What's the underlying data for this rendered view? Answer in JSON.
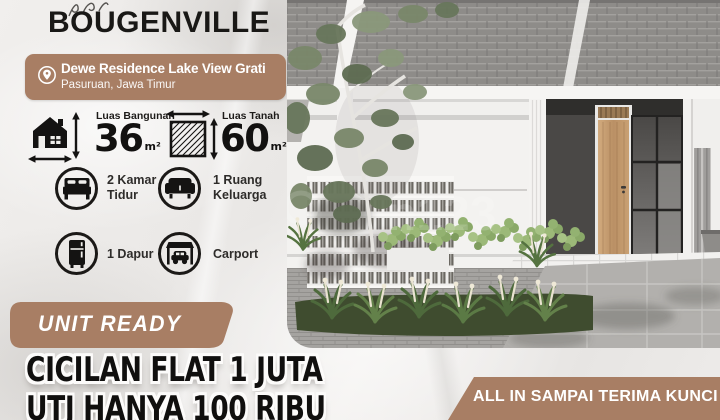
{
  "title": "BOUGENVILLE",
  "location": {
    "name": "Dewe Residence Lake View Grati",
    "region": "Pasuruan, Jawa Timur"
  },
  "specs": {
    "building": {
      "label": "Luas Bangunan",
      "value": "36",
      "unit": "m²"
    },
    "land": {
      "label": "Luas Tanah",
      "value": "60",
      "unit": "m²"
    }
  },
  "features": {
    "bedroom": {
      "line1": "2 Kamar",
      "line2": "Tidur"
    },
    "living": {
      "line1": "1 Ruang",
      "line2": "Keluarga"
    },
    "kitchen": {
      "label": "1 Dapur"
    },
    "carport": {
      "label": "Carport"
    }
  },
  "badges": {
    "unit_ready": "UNIT READY",
    "all_in": "ALL IN SAMPAI TERIMA KUNCI"
  },
  "promo": {
    "line1": "CICILAN FLAT 1 JUTA",
    "line2": "UTJ HANYA 100 RIBU"
  },
  "watermark": "n123",
  "colors": {
    "accent": "#a87e64",
    "text_dark": "#171513"
  }
}
